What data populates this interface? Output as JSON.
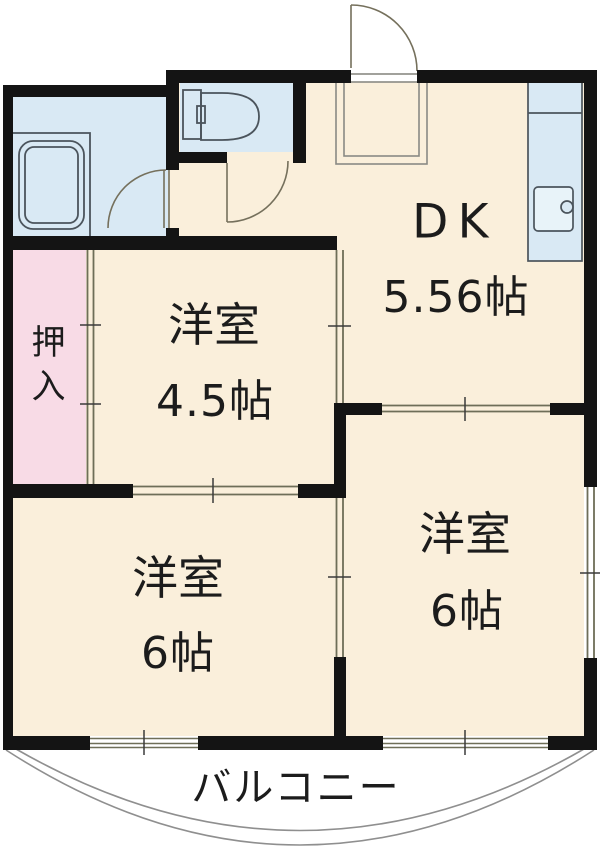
{
  "rooms": {
    "dk": {
      "label": "DK",
      "area": "5.56帖"
    },
    "western_4_5": {
      "label": "洋室",
      "area": "4.5帖"
    },
    "western_6_left": {
      "label": "洋室",
      "area": "6帖"
    },
    "western_6_right": {
      "label": "洋室",
      "area": "6帖"
    },
    "closet": {
      "label": "押入"
    },
    "balcony": {
      "label": "バルコニー"
    }
  },
  "colors": {
    "floor": "#faefdb",
    "wet_area": "#d9e9f4",
    "closet": "#f8dbe6",
    "wall": "#141414",
    "fixture_line": "#4b545c",
    "track_line": "#6e6e58",
    "door_arc": "#75705c",
    "balcony_line": "#8f8f8f",
    "text": "#1c1c1c"
  }
}
